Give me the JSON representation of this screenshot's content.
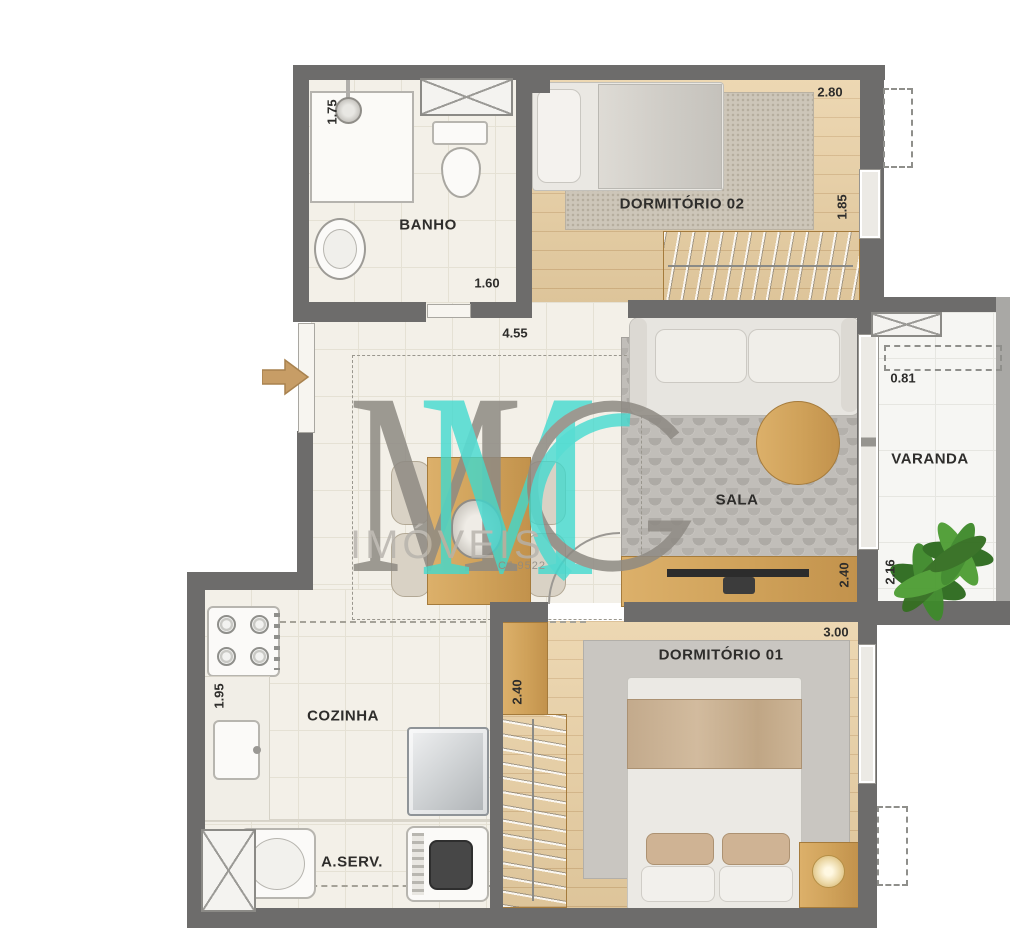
{
  "watermark": {
    "monogram_letter_m": "M",
    "company": "IMÓVEIS",
    "license": "CJ 9522"
  },
  "rooms": [
    {
      "label": "BANHO",
      "dimensions": [
        "1.75",
        "1.60"
      ]
    },
    {
      "label": "DORMITÓRIO 02",
      "dimensions": [
        "2.80",
        "1.85"
      ]
    },
    {
      "label": "SALA",
      "dimensions": [
        "4.55",
        "2.40"
      ]
    },
    {
      "label": "VARANDA",
      "dimensions": [
        "0.81",
        "2.16"
      ]
    },
    {
      "label": "COZINHA",
      "dimensions": [
        "1.95"
      ]
    },
    {
      "label": "A.SERV.",
      "dimensions": []
    },
    {
      "label": "DORMITÓRIO 01",
      "dimensions": [
        "3.00",
        "2.40"
      ]
    }
  ],
  "icons": {
    "entrance_arrow": "right-arrow",
    "plant": "potted-plant"
  },
  "colors": {
    "wall": "#6d6c6b",
    "tile_floor": "#f3f0e8",
    "wood_floor": "#e9cfa2",
    "wood_furniture": "#d0a159",
    "sala_rug": "#b6b3ae",
    "logo_teal": "#3ed9cf",
    "logo_gray": "#8e8a83",
    "plant_green": "#3f8a2c",
    "arrow_tan": "#c79d66"
  }
}
